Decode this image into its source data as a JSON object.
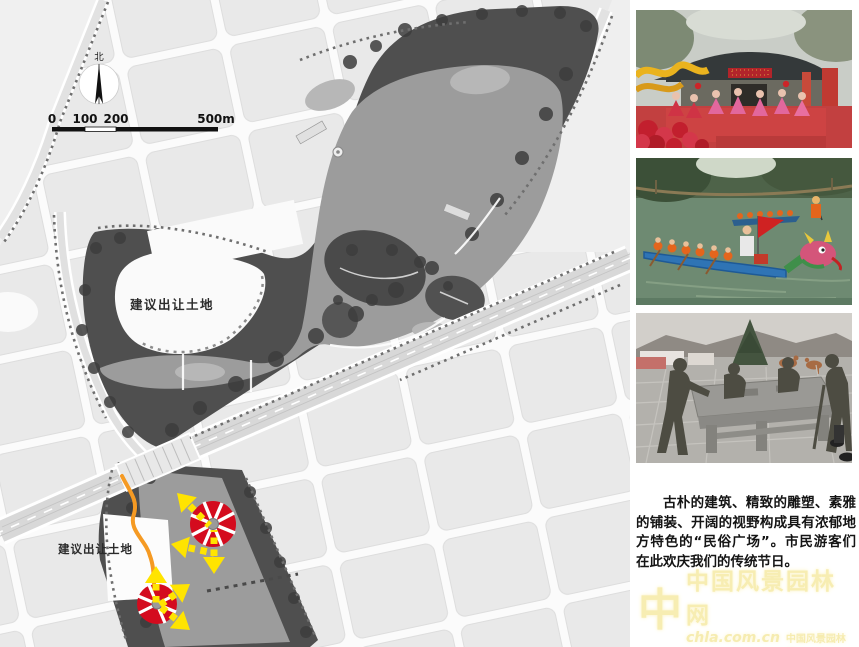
{
  "map": {
    "north_label": "北",
    "scale_bar": {
      "tick0": "0",
      "tick1": "100",
      "tick2": "200",
      "tick3": "500m"
    },
    "parcel_label_upper": "建议出让土地",
    "parcel_label_lower": "建议出让土地",
    "colors": {
      "viewpoint_node_red": "#d40b1e",
      "view_arrow_yellow": "#ffe400",
      "route_orange": "#f59a23",
      "park_dark": "#4f4f4f",
      "water_gray": "#9c9c9c",
      "block_gray": "#e9e9e9"
    }
  },
  "photos": {
    "photo1_name": "folk-festival-performance",
    "photo2_name": "dragon-boat-race",
    "photo3_name": "bronze-sculpture-plaza"
  },
  "caption": {
    "text": "古朴的建筑、精致的雕塑、素雅的铺装、开阔的视野构成具有浓郁地方特色的“民俗广场”。市民游客们在此欢庆我们的传统节日。"
  },
  "watermark": {
    "logo_glyph": "中",
    "site_name": "中国风景园林网",
    "site_url": "chla.com.cn",
    "site_name_small": "中国风景园林网"
  }
}
